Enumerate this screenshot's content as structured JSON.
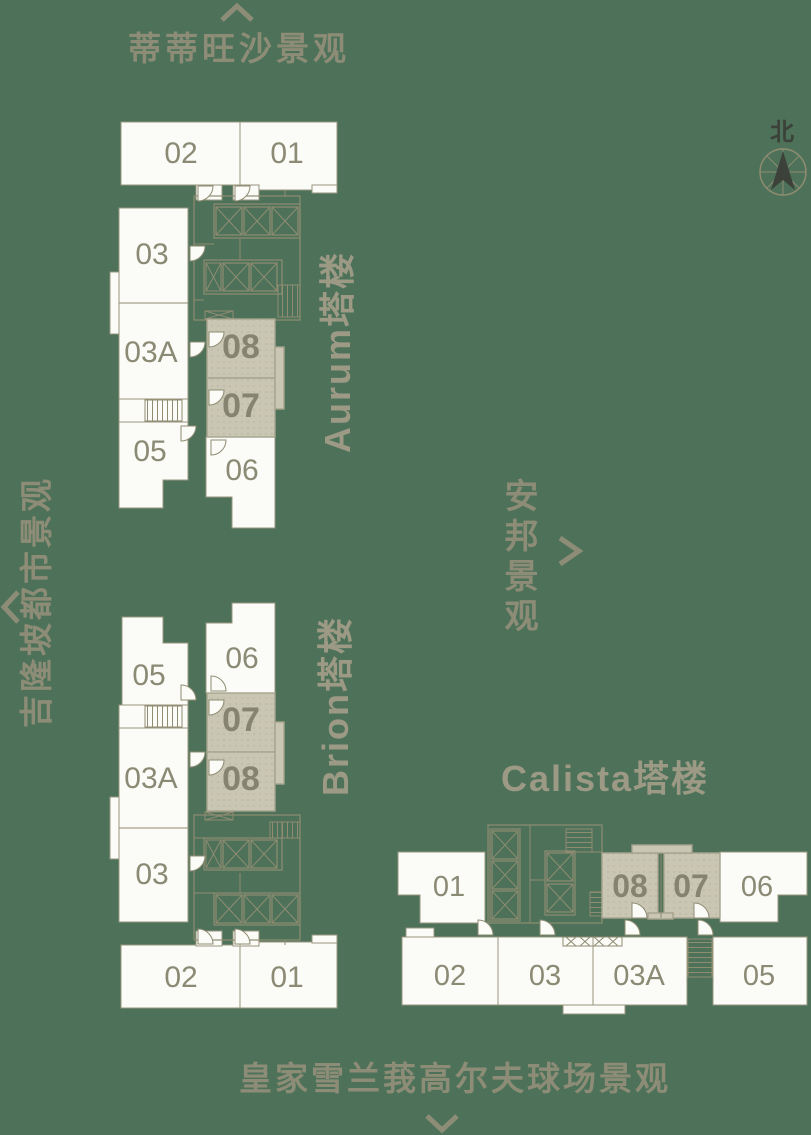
{
  "palette": {
    "background": "#4D7259",
    "unit_fill": "#FBFBF7",
    "highlight_fill": "#C9C6B3",
    "plan_line": "#8F8C72",
    "unit_number": "#8B8A74",
    "tower_name": "#9C9985",
    "view_text": "#8D8C76",
    "compass_ink": "#3C4139"
  },
  "compass": {
    "north_label": "北"
  },
  "views": {
    "north": "蒂蒂旺沙景观",
    "west": "吉隆坡都市景观",
    "east": "安邦景观",
    "south": "皇家雪兰莪高尔夫球场景观"
  },
  "towers": {
    "aurum": {
      "name": "Aurum塔楼",
      "units": [
        {
          "label": "02",
          "highlighted": false
        },
        {
          "label": "01",
          "highlighted": false
        },
        {
          "label": "03",
          "highlighted": false
        },
        {
          "label": "03A",
          "highlighted": false
        },
        {
          "label": "05",
          "highlighted": false
        },
        {
          "label": "08",
          "highlighted": true
        },
        {
          "label": "07",
          "highlighted": true
        },
        {
          "label": "06",
          "highlighted": false
        }
      ]
    },
    "brion": {
      "name": "Brion塔楼",
      "units": [
        {
          "label": "05",
          "highlighted": false
        },
        {
          "label": "06",
          "highlighted": false
        },
        {
          "label": "07",
          "highlighted": true
        },
        {
          "label": "08",
          "highlighted": true
        },
        {
          "label": "03A",
          "highlighted": false
        },
        {
          "label": "03",
          "highlighted": false
        },
        {
          "label": "02",
          "highlighted": false
        },
        {
          "label": "01",
          "highlighted": false
        }
      ]
    },
    "calista": {
      "name": "Calista塔楼",
      "units": [
        {
          "label": "01",
          "highlighted": false
        },
        {
          "label": "08",
          "highlighted": true
        },
        {
          "label": "07",
          "highlighted": true
        },
        {
          "label": "06",
          "highlighted": false
        },
        {
          "label": "02",
          "highlighted": false
        },
        {
          "label": "03",
          "highlighted": false
        },
        {
          "label": "03A",
          "highlighted": false
        },
        {
          "label": "05",
          "highlighted": false
        }
      ]
    }
  }
}
